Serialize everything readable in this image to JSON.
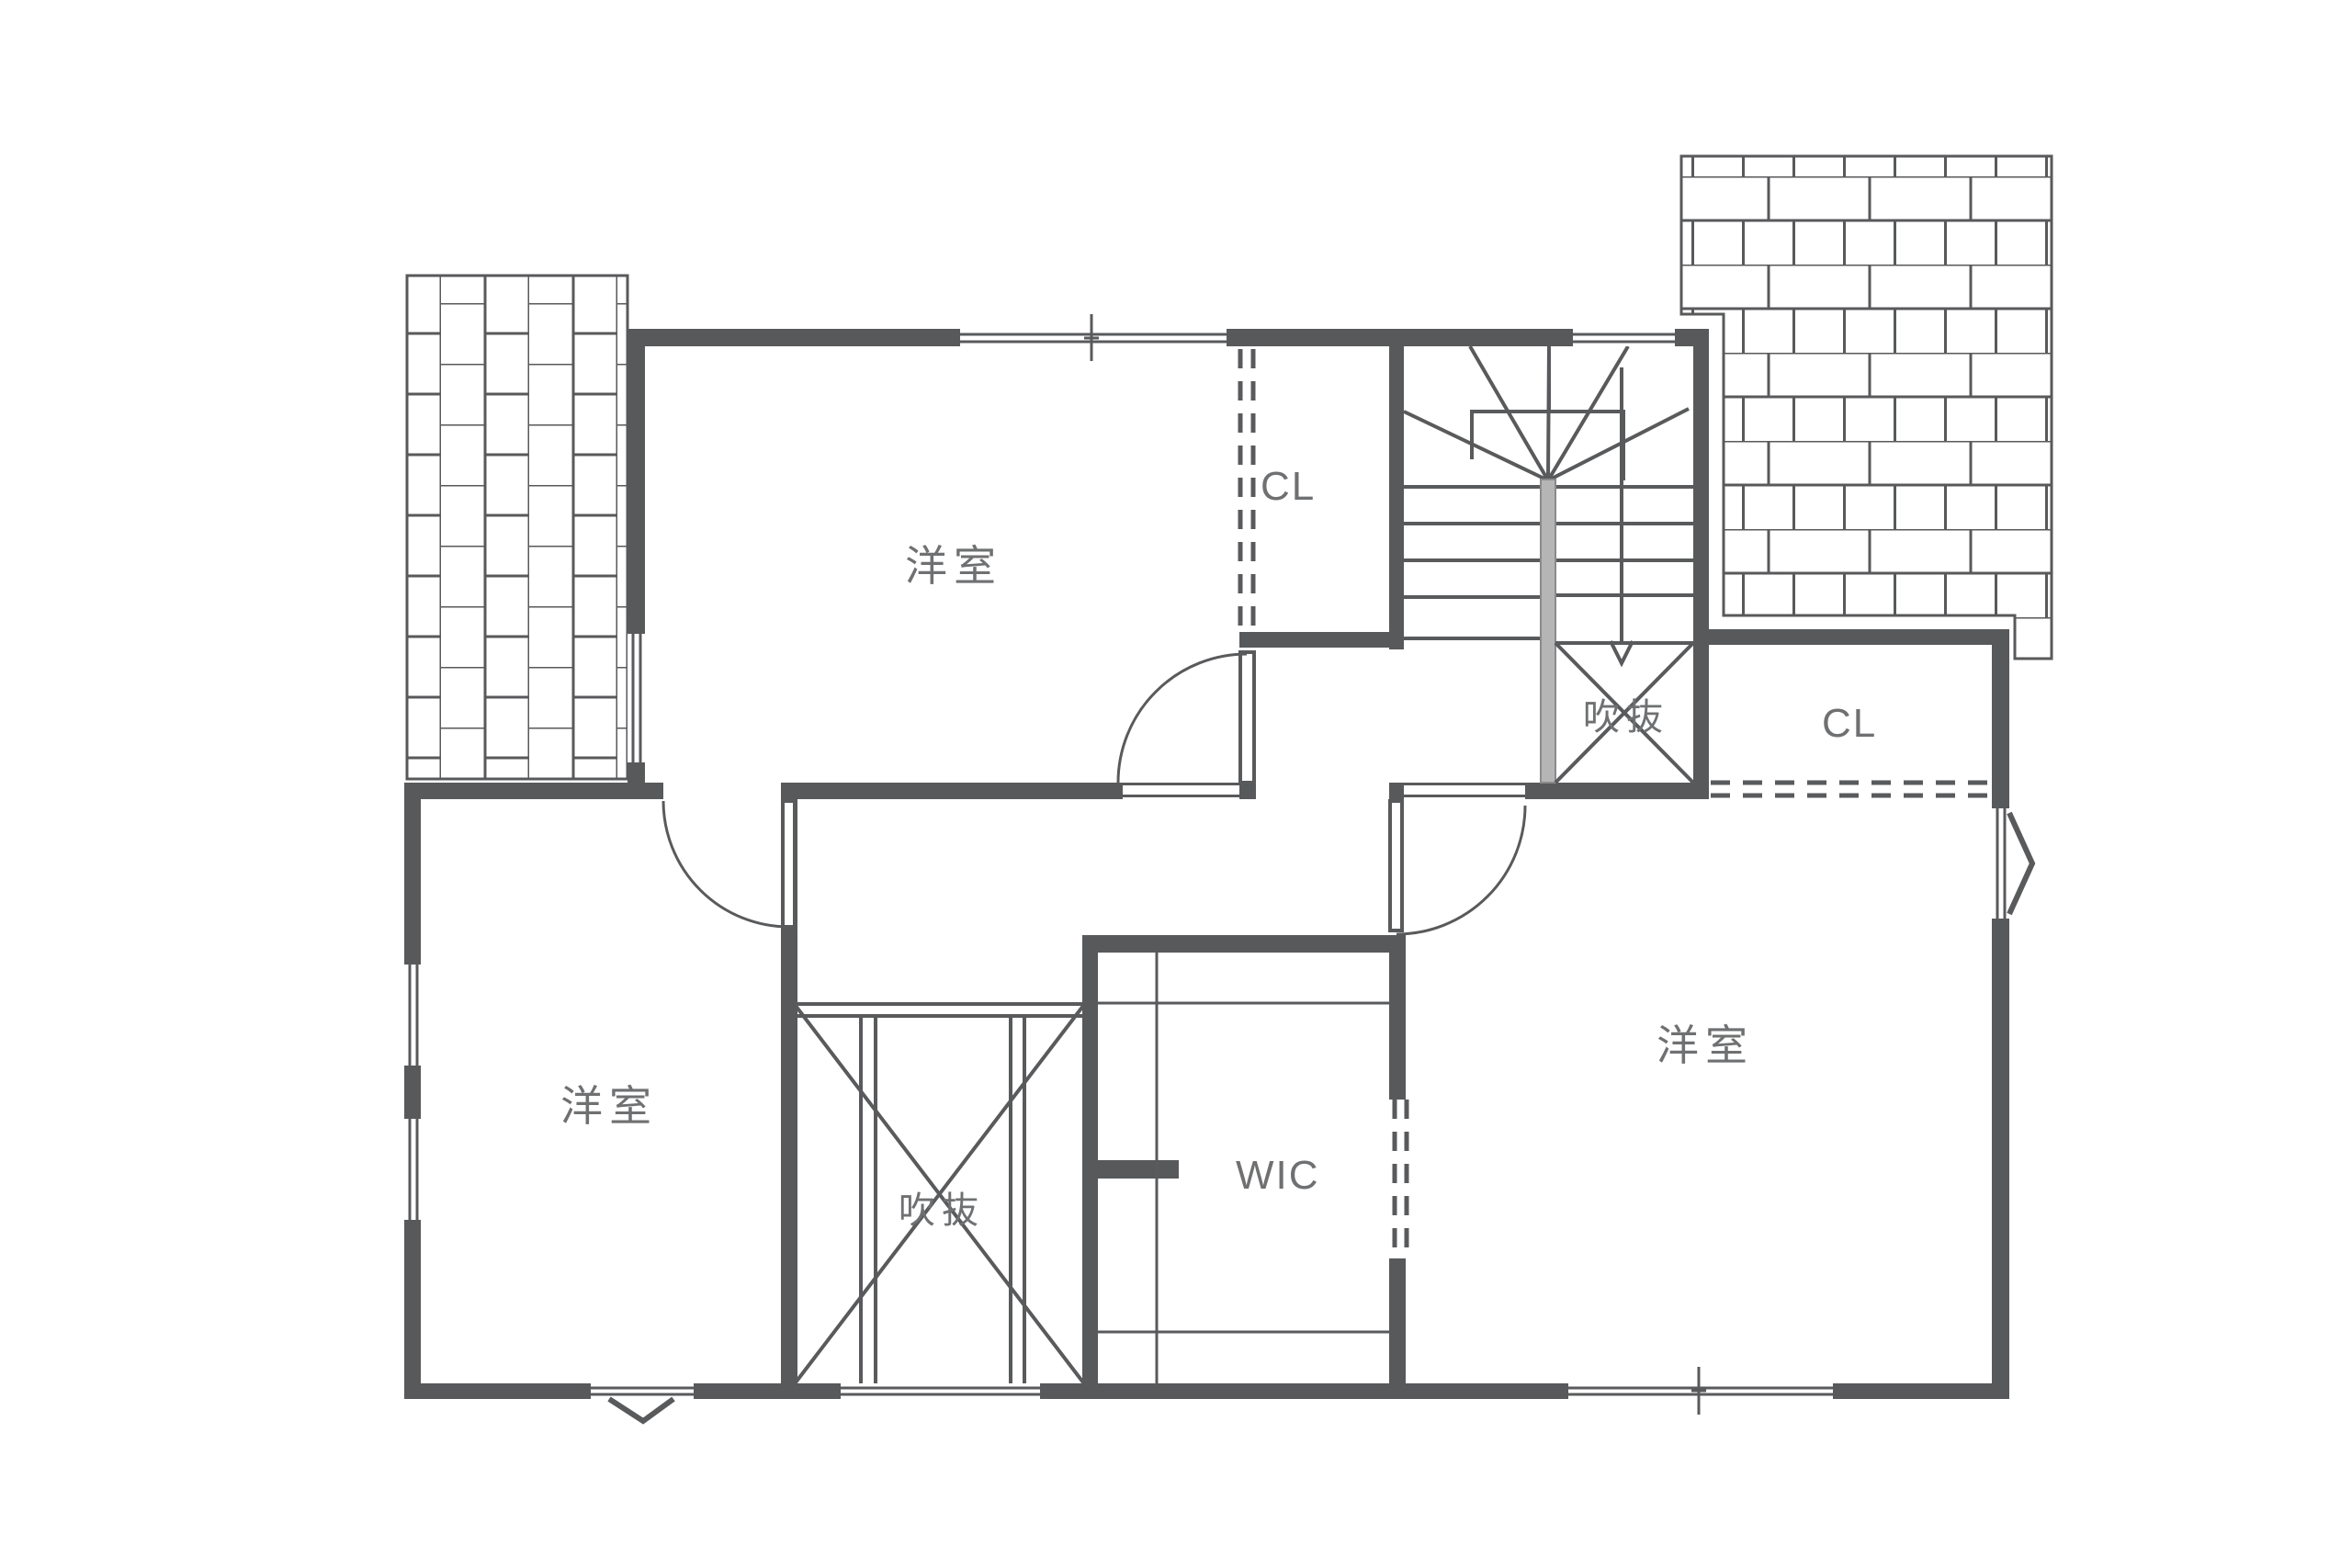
{
  "document": {
    "type": "architectural-floor-plan",
    "floor": "2F"
  },
  "rooms": [
    {
      "name": "bedroom-top",
      "label": "洋室"
    },
    {
      "name": "bedroom-bottom-left",
      "label": "洋室"
    },
    {
      "name": "bedroom-bottom-right",
      "label": "洋室"
    },
    {
      "name": "closet-top",
      "label": "CL"
    },
    {
      "name": "closet-right",
      "label": "CL"
    },
    {
      "name": "void-stairwell",
      "label": "吹抜"
    },
    {
      "name": "void-center",
      "label": "吹抜"
    },
    {
      "name": "walk-in-closet",
      "label": "WIC"
    }
  ],
  "colors": {
    "wall": "#58595b",
    "line": "#595a5c",
    "text": "#6f7072",
    "stair_newel": "#b5b5b6",
    "background": "#ffffff"
  }
}
